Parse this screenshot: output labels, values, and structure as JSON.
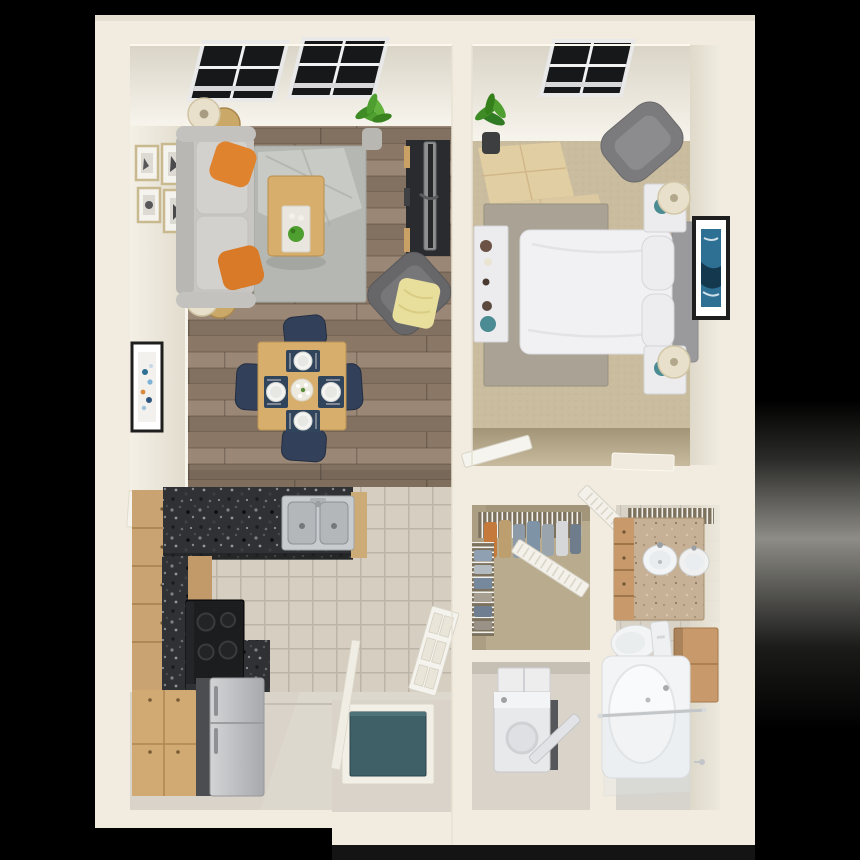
{
  "scene": {
    "type": "3d-rendered-floor-plan",
    "description": "Top-down 3D architectural render of a one-bedroom, one-bathroom apartment",
    "rooms": [
      {
        "name": "living-room",
        "furniture": [
          "gray-sofa",
          "orange-throw-pillows",
          "area-rug",
          "coffee-table",
          "tv-console",
          "flat-screen-tv",
          "accent-armchair",
          "yellow-throw-blanket",
          "floor-lamps",
          "round-side-tables",
          "gallery-wall-frames",
          "abstract-art-frame",
          "potted-plant",
          "picture-window"
        ]
      },
      {
        "name": "dining-area",
        "furniture": [
          "square-oak-table",
          "navy-dining-chairs",
          "place-settings",
          "flower-centerpiece"
        ]
      },
      {
        "name": "bedroom",
        "furniture": [
          "bed-white-duvet",
          "gray-headboard",
          "nightstands",
          "teal-table-lamps",
          "wingback-chair",
          "white-dresser",
          "area-rug",
          "abstract-art-frame",
          "potted-plant",
          "picture-window",
          "carpet-sunlight-patches"
        ]
      },
      {
        "name": "kitchen",
        "furniture": [
          "granite-counter",
          "double-stainless-sink",
          "black-range",
          "stainless-refrigerator",
          "wood-cabinets",
          "pantry-cabinet",
          "tile-floor"
        ]
      },
      {
        "name": "walk-in-closet",
        "furniture": [
          "wire-shelving",
          "hanging-clothes",
          "folded-clothes",
          "louvered-door"
        ]
      },
      {
        "name": "laundry-closet",
        "furniture": [
          "washer-dryer-unit",
          "wall-cabinet"
        ]
      },
      {
        "name": "bathroom",
        "furniture": [
          "vanity-with-sink",
          "mirror-reflection-sink",
          "toilet",
          "bathtub",
          "shower-rod",
          "glass-panel",
          "wood-wall-cabinet",
          "wire-linen-shelf",
          "louvered-door",
          "towel-hook",
          "tile-floor"
        ]
      },
      {
        "name": "entry",
        "furniture": [
          "teal-front-door",
          "white-door-frame",
          "open-interior-door",
          "six-panel-hall-door"
        ]
      }
    ]
  },
  "palette": {
    "background": "#000000",
    "wall": "#f1ecdf",
    "wood_floor": "#94806d",
    "rug_living": "#b5b7b2",
    "sofa_gray": "#c8c6c3",
    "pillow_orange": "#e0832f",
    "oak_wood": "#d8ae6c",
    "tv_console_dark": "#2a2b2e",
    "armchair_gray": "#67676a",
    "throw_yellow": "#e9df9d",
    "chair_navy": "#334059",
    "carpet_beige": "#cabc9e",
    "sun_patch": "#e7d2a4",
    "rug_bedroom": "#a9a295",
    "bed_white": "#f1f1f3",
    "headboard_gray": "#9a999b",
    "furniture_white": "#ececee",
    "lamp_teal": "#4b8b93",
    "lamp_shade_cream": "#e8e0ca",
    "granite_dark": "#2f3134",
    "cabinet_wood": "#c9a371",
    "pantry_wood": "#d0a973",
    "fridge_steel": "#c3c5c8",
    "tile_kitchen": "#d6cfc1",
    "tile_bath": "#d8d2c7",
    "floor_smooth": "#d9d3c9",
    "closet_tan": "#b8ab8e",
    "front_door_teal": "#3e6066",
    "vanity_tan": "#c6b096",
    "bath_cabinet_wood": "#c89a6b",
    "fixture_white": "#f3f4f5",
    "appliance_white": "#e8e9eb",
    "plant_green": "#4f9e30",
    "art_blue": "#2e6f94",
    "frame_black": "#1e1e1e",
    "frame_gold": "#c9b98f",
    "window_glass": "#17181a"
  }
}
